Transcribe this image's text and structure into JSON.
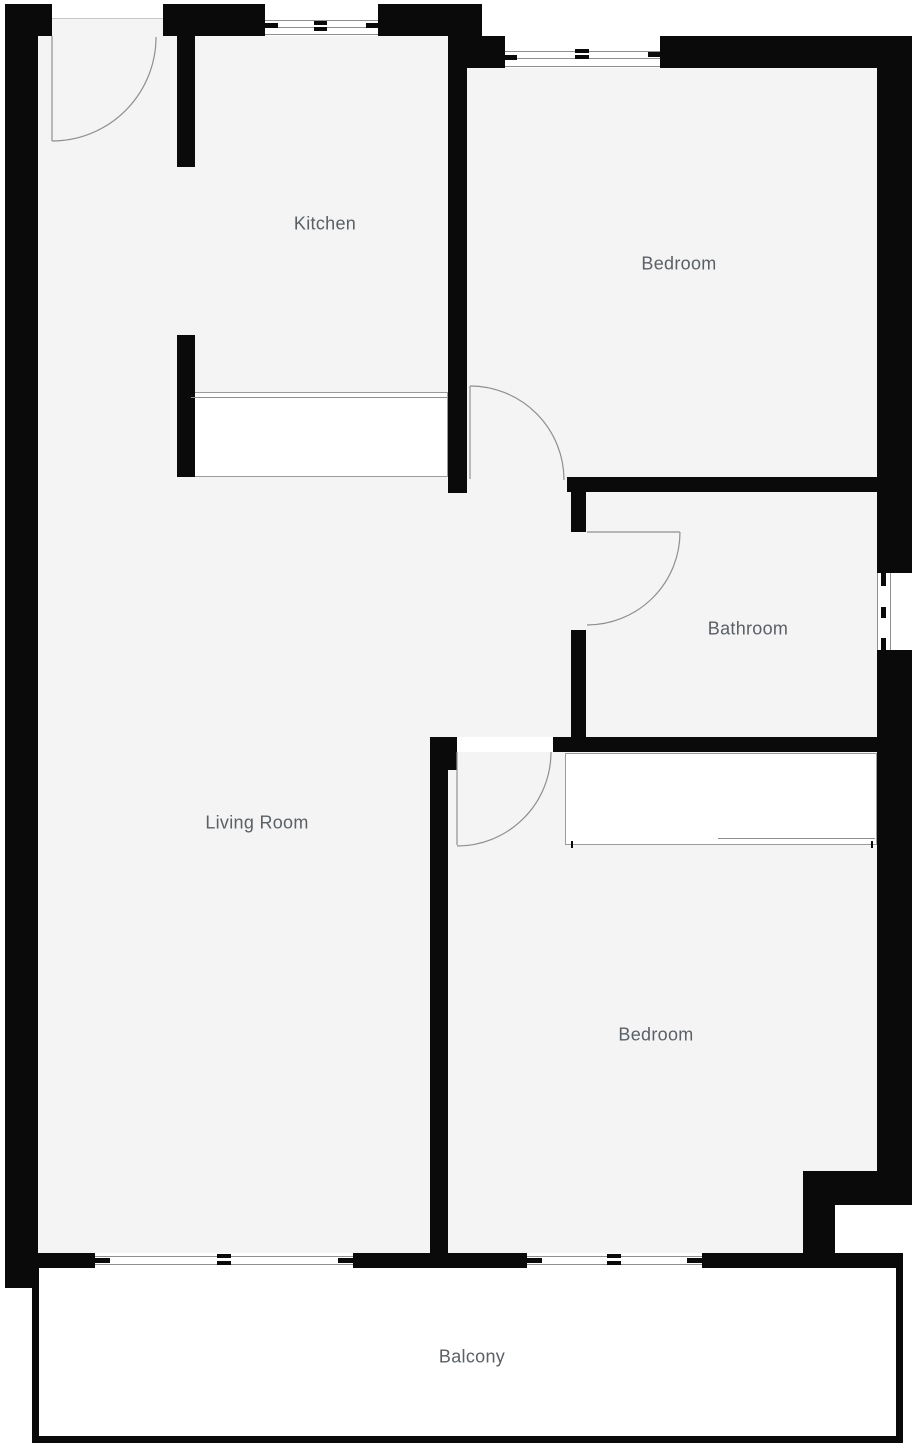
{
  "floorplan": {
    "canvas": {
      "width": 915,
      "height": 1448,
      "background_color": "#ffffff",
      "floor_color": "#f4f4f5",
      "wall_color": "#0a0a0a",
      "thin_line_color": "#8f8f8f",
      "label_color": "#5a6065"
    },
    "labels": [
      {
        "id": "kitchen",
        "text": "Kitchen",
        "x": 325,
        "y": 224
      },
      {
        "id": "bedroom-1",
        "text": "Bedroom",
        "x": 679,
        "y": 264
      },
      {
        "id": "bathroom",
        "text": "Bathroom",
        "x": 748,
        "y": 629
      },
      {
        "id": "living-room",
        "text": "Living Room",
        "x": 257,
        "y": 823
      },
      {
        "id": "bedroom-2",
        "text": "Bedroom",
        "x": 656,
        "y": 1035
      },
      {
        "id": "balcony",
        "text": "Balcony",
        "x": 472,
        "y": 1357
      }
    ],
    "floors": [
      {
        "name": "entry-kitchen-floor",
        "x": 38,
        "y": 36,
        "w": 410,
        "h": 457
      },
      {
        "name": "bedroom1-floor",
        "x": 467,
        "y": 68,
        "w": 410,
        "h": 409
      },
      {
        "name": "hall-bathroom-floor",
        "x": 448,
        "y": 477,
        "w": 429,
        "h": 260
      },
      {
        "name": "living-room-floor",
        "x": 38,
        "y": 477,
        "w": 410,
        "h": 776
      },
      {
        "name": "bedroom2-floor",
        "x": 448,
        "y": 752,
        "w": 429,
        "h": 501
      },
      {
        "name": "entry-threshold-floor",
        "x": 52,
        "y": 19,
        "w": 111,
        "h": 18
      }
    ],
    "walls": [
      {
        "name": "top-wall-left-of-door",
        "x": 5,
        "y": 4,
        "w": 47,
        "h": 32
      },
      {
        "name": "top-wall-door-to-window",
        "x": 163,
        "y": 4,
        "w": 102,
        "h": 32
      },
      {
        "name": "top-wall-window-to-step",
        "x": 378,
        "y": 4,
        "w": 104,
        "h": 32
      },
      {
        "name": "bedroom1-top-wall-left",
        "x": 448,
        "y": 36,
        "w": 57,
        "h": 32
      },
      {
        "name": "bedroom1-top-wall-right",
        "x": 660,
        "y": 36,
        "w": 252,
        "h": 32
      },
      {
        "name": "left-outer-wall",
        "x": 5,
        "y": 4,
        "w": 33,
        "h": 1284
      },
      {
        "name": "right-outer-wall-upper",
        "x": 877,
        "y": 36,
        "w": 35,
        "h": 537
      },
      {
        "name": "right-outer-wall-lower",
        "x": 877,
        "y": 650,
        "w": 35,
        "h": 555
      },
      {
        "name": "kitchen-left-wall-upper",
        "x": 177,
        "y": 36,
        "w": 18,
        "h": 131
      },
      {
        "name": "kitchen-left-wall-lower",
        "x": 177,
        "y": 335,
        "w": 18,
        "h": 142
      },
      {
        "name": "kitchen-right-wall",
        "x": 448,
        "y": 36,
        "w": 19,
        "h": 457
      },
      {
        "name": "bedroom1-bottom-wall",
        "x": 567,
        "y": 477,
        "w": 310,
        "h": 15
      },
      {
        "name": "bathroom-left-wall-upper",
        "x": 571,
        "y": 492,
        "w": 15,
        "h": 40
      },
      {
        "name": "bathroom-left-wall-lower",
        "x": 571,
        "y": 630,
        "w": 15,
        "h": 107
      },
      {
        "name": "bathroom-bottom-wall",
        "x": 553,
        "y": 737,
        "w": 359,
        "h": 15
      },
      {
        "name": "bedroom2-top-stub",
        "x": 430,
        "y": 737,
        "w": 27,
        "h": 33
      },
      {
        "name": "bedroom2-left-wall",
        "x": 430,
        "y": 737,
        "w": 18,
        "h": 516
      },
      {
        "name": "bottom-wall-left",
        "x": 38,
        "y": 1253,
        "w": 57,
        "h": 15
      },
      {
        "name": "bottom-wall-middle",
        "x": 353,
        "y": 1253,
        "w": 174,
        "h": 15
      },
      {
        "name": "bottom-wall-right",
        "x": 702,
        "y": 1253,
        "w": 201,
        "h": 15
      },
      {
        "name": "bedroom2-step-horizontal",
        "x": 803,
        "y": 1171,
        "w": 74,
        "h": 34
      },
      {
        "name": "bedroom2-step-vertical",
        "x": 803,
        "y": 1205,
        "w": 32,
        "h": 48
      },
      {
        "name": "balcony-rail-left",
        "x": 32,
        "y": 1268,
        "w": 7,
        "h": 175
      },
      {
        "name": "balcony-rail-bottom",
        "x": 32,
        "y": 1436,
        "w": 871,
        "h": 7
      },
      {
        "name": "balcony-rail-right",
        "x": 896,
        "y": 1268,
        "w": 7,
        "h": 175
      }
    ],
    "patches": [
      {
        "name": "kitchen-window-opening",
        "x": 265,
        "y": 4,
        "w": 113,
        "h": 32
      },
      {
        "name": "bedroom1-window-opening",
        "x": 505,
        "y": 36,
        "w": 155,
        "h": 32
      },
      {
        "name": "bathroom-window-opening",
        "x": 877,
        "y": 573,
        "w": 35,
        "h": 77
      },
      {
        "name": "living-window-opening",
        "x": 95,
        "y": 1253,
        "w": 258,
        "h": 15
      },
      {
        "name": "bedroom2-window-opening",
        "x": 527,
        "y": 1253,
        "w": 175,
        "h": 15
      },
      {
        "name": "exterior-notch",
        "x": 835,
        "y": 1205,
        "w": 77,
        "h": 48
      },
      {
        "name": "balcony-interior",
        "x": 39,
        "y": 1268,
        "w": 857,
        "h": 168
      }
    ],
    "window_lines": [
      {
        "x": 265,
        "y": 20,
        "w": 113,
        "h": 1
      },
      {
        "x": 265,
        "y": 27,
        "w": 113,
        "h": 1
      },
      {
        "x": 265,
        "y": 34,
        "w": 113,
        "h": 1
      },
      {
        "x": 505,
        "y": 51,
        "w": 155,
        "h": 1
      },
      {
        "x": 505,
        "y": 58,
        "w": 155,
        "h": 1
      },
      {
        "x": 505,
        "y": 66,
        "w": 155,
        "h": 1
      },
      {
        "x": 877,
        "y": 573,
        "w": 1,
        "h": 77
      },
      {
        "x": 890,
        "y": 573,
        "w": 1,
        "h": 77
      },
      {
        "x": 95,
        "y": 1256,
        "w": 258,
        "h": 1
      },
      {
        "x": 95,
        "y": 1264,
        "w": 258,
        "h": 1
      },
      {
        "x": 527,
        "y": 1256,
        "w": 175,
        "h": 1
      },
      {
        "x": 527,
        "y": 1264,
        "w": 175,
        "h": 1
      }
    ],
    "window_ticks": [
      {
        "x": 265,
        "y": 23,
        "w": 13,
        "h": 5
      },
      {
        "x": 314,
        "y": 21,
        "w": 13,
        "h": 4
      },
      {
        "x": 314,
        "y": 27,
        "w": 13,
        "h": 4
      },
      {
        "x": 366,
        "y": 23,
        "w": 12,
        "h": 5
      },
      {
        "x": 505,
        "y": 55,
        "w": 12,
        "h": 5
      },
      {
        "x": 575,
        "y": 49,
        "w": 14,
        "h": 4
      },
      {
        "x": 575,
        "y": 55,
        "w": 14,
        "h": 4
      },
      {
        "x": 648,
        "y": 52,
        "w": 12,
        "h": 5
      },
      {
        "x": 881,
        "y": 573,
        "w": 5,
        "h": 13
      },
      {
        "x": 881,
        "y": 607,
        "w": 5,
        "h": 11
      },
      {
        "x": 881,
        "y": 638,
        "w": 5,
        "h": 12
      },
      {
        "x": 95,
        "y": 1258,
        "w": 15,
        "h": 5
      },
      {
        "x": 217,
        "y": 1254,
        "w": 14,
        "h": 4
      },
      {
        "x": 217,
        "y": 1261,
        "w": 14,
        "h": 4
      },
      {
        "x": 338,
        "y": 1258,
        "w": 15,
        "h": 5
      },
      {
        "x": 527,
        "y": 1258,
        "w": 15,
        "h": 5
      },
      {
        "x": 607,
        "y": 1254,
        "w": 14,
        "h": 4
      },
      {
        "x": 607,
        "y": 1261,
        "w": 14,
        "h": 4
      },
      {
        "x": 687,
        "y": 1258,
        "w": 15,
        "h": 5
      },
      {
        "x": 571,
        "y": 841,
        "w": 2,
        "h": 7
      },
      {
        "x": 871,
        "y": 841,
        "w": 2,
        "h": 7
      }
    ],
    "soft_lines": [
      {
        "name": "entry-threshold-line",
        "x": 52,
        "y": 18,
        "w": 111,
        "h": 1
      }
    ],
    "doors": [
      {
        "name": "entry-door",
        "leaf": "M 52 36 L 52 141",
        "arc": "M 156 37 A 104 104 0 0 1 52 141"
      },
      {
        "name": "bedroom1-door",
        "leaf": "M 470 386 L 470 479",
        "arc": "M 470 386 A 94 94 0 0 1 564 480"
      },
      {
        "name": "bathroom-door",
        "leaf": "M 587 532 L 680 532",
        "arc": "M 680 532 A 93 93 0 0 1 587 625"
      },
      {
        "name": "bedroom2-door",
        "leaf": "M 457 752 L 457 845",
        "arc": "M 551 752 A 94 94 0 0 1 457 846"
      }
    ],
    "furniture": [
      {
        "name": "kitchen-counter",
        "x": 190,
        "y": 392,
        "w": 258,
        "h": 85,
        "inner_line": {
          "x": 191,
          "y": 397,
          "w": 256,
          "h": 1
        }
      },
      {
        "name": "bedroom2-wardrobe",
        "x": 565,
        "y": 753,
        "w": 312,
        "h": 92,
        "inner_line": {
          "x": 718,
          "y": 838,
          "w": 157,
          "h": 1
        }
      }
    ]
  }
}
